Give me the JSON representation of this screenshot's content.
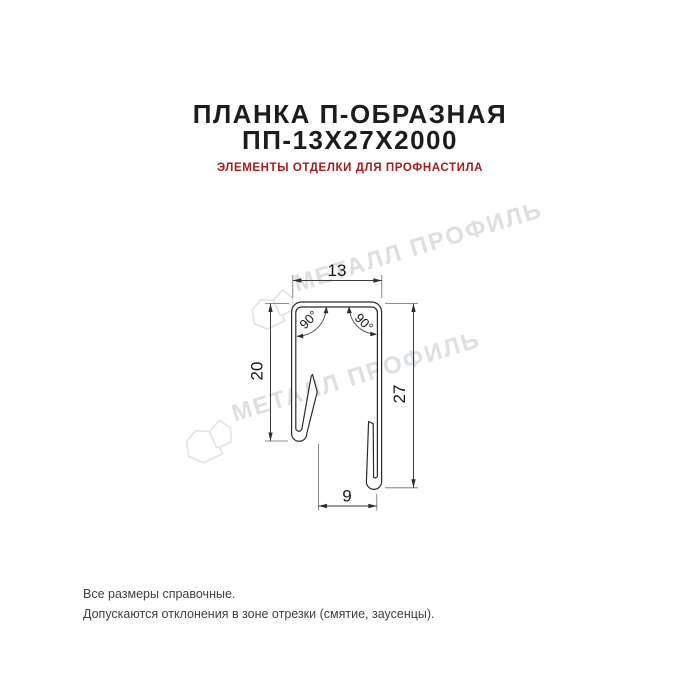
{
  "header": {
    "title_line1": "ПЛАНКА П-ОБРАЗНАЯ",
    "title_line2": "ПП-13Х27Х2000",
    "subtitle": "ЭЛЕМЕНТЫ ОТДЕЛКИ ДЛЯ ПРОФНАСТИЛА",
    "title_color": "#1c1c1a",
    "subtitle_color": "#a51d1d"
  },
  "watermark": {
    "text": "МЕТАЛЛ ПРОФИЛЬ",
    "color": "#dde0e3",
    "logo_icon": "metall-profil-logo"
  },
  "drawing": {
    "type": "technical-profile-cross-section",
    "line_color": "#2b2b2b",
    "dimensions": {
      "top_width": "13",
      "left_height": "20",
      "right_height": "27",
      "bottom_width": "9",
      "angle_left": "90°",
      "angle_right": "90°"
    }
  },
  "footer": {
    "line1": "Все размеры справочные.",
    "line2": "Допускаются отклонения в зоне отрезки (смятие, заусенцы)."
  }
}
